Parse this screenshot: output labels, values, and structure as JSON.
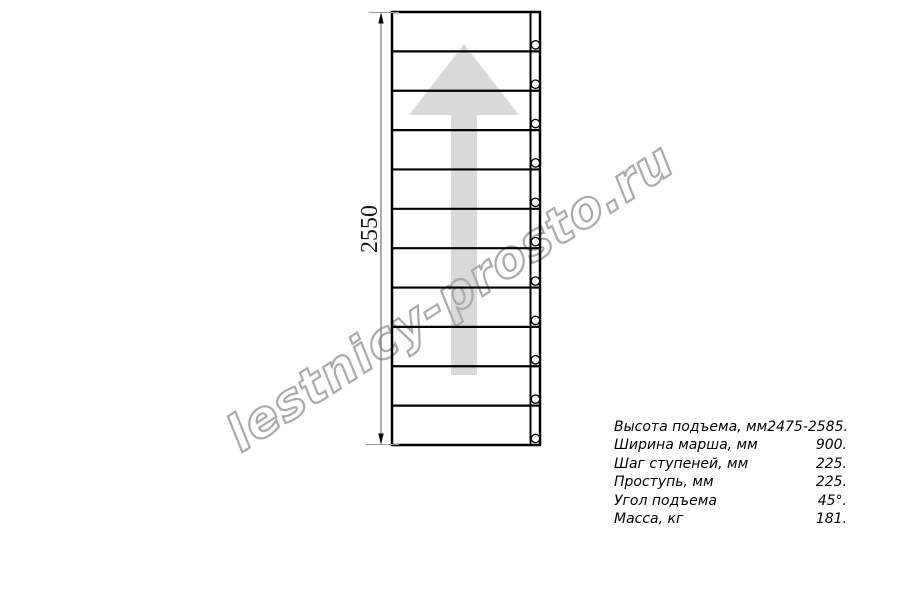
{
  "page": {
    "background": "#ffffff"
  },
  "watermark": {
    "text": "lestnicy-prosto.ru",
    "color": "#aaaaaa"
  },
  "drawing": {
    "dimension_label": "2550",
    "steps_count": 11,
    "bolt_holes_count": 11,
    "arrow_color": "#d9d9d9",
    "line_color": "#000000"
  },
  "specs": {
    "rows": [
      {
        "label": "Высота подъема, мм",
        "value": "2475-2585."
      },
      {
        "label": "Ширина марша, мм",
        "value": "900."
      },
      {
        "label": "Шаг ступеней, мм",
        "value": "225."
      },
      {
        "label": "Проступь, мм",
        "value": "225."
      },
      {
        "label": "Угол подъема",
        "value": "45°."
      },
      {
        "label": "Масса, кг",
        "value": "181."
      }
    ]
  }
}
